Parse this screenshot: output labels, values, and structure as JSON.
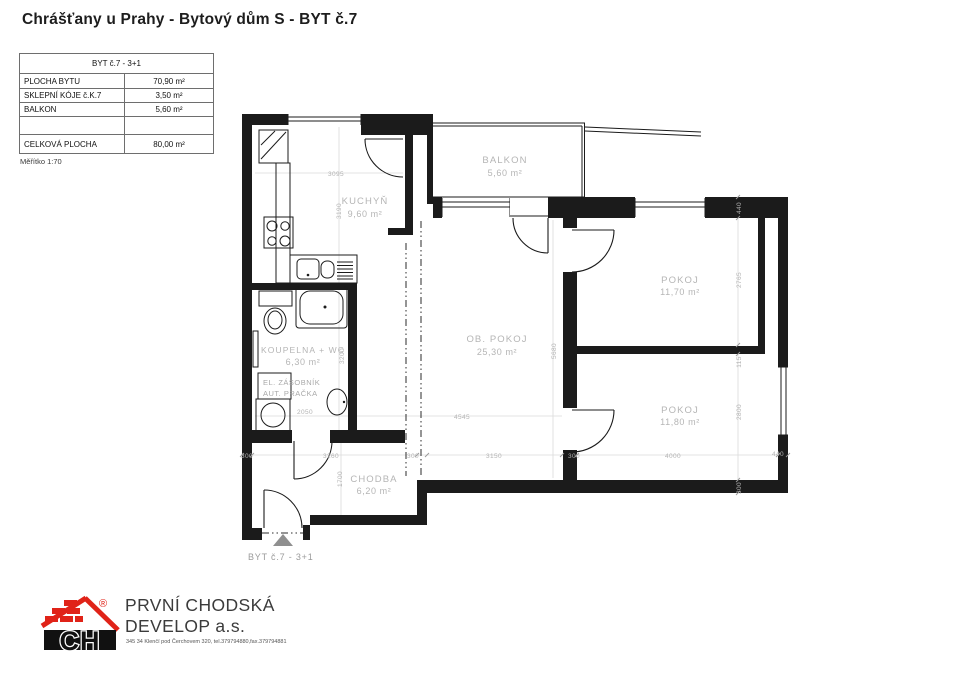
{
  "header": {
    "title": "Chrášťany u Prahy - Bytový dům S - BYT č.7"
  },
  "info_table": {
    "header": "BYT č.7 - 3+1",
    "rows": [
      {
        "label": "PLOCHA BYTU",
        "value": "70,90 m²"
      },
      {
        "label": "SKLEPNÍ KÓJE č.K.7",
        "value": "3,50 m²"
      },
      {
        "label": "BALKON",
        "value": "5,60 m²"
      },
      {
        "label": "",
        "value": ""
      },
      {
        "label": "CELKOVÁ PLOCHA",
        "value": "80,00 m²"
      }
    ],
    "scale_note": "Měřítko 1:70"
  },
  "plan": {
    "rooms": [
      {
        "name": "KUCHYŇ",
        "area": "9,60 m²"
      },
      {
        "name": "BALKON",
        "area": "5,60 m²"
      },
      {
        "name": "OB. POKOJ",
        "area": "25,30 m²"
      },
      {
        "name": "POKOJ",
        "area": "11,70 m²"
      },
      {
        "name": "POKOJ",
        "area": "11,80 m²"
      },
      {
        "name": "KOUPELNA + WC",
        "area": "6,30 m²"
      },
      {
        "name": "CHODBA",
        "area": "6,20 m²"
      }
    ],
    "appliance_labels": [
      "EL. ZÁSOBNÍK",
      "AUT. PRAČKA"
    ],
    "entrance_label": "BYT č.7 - 3+1",
    "dimensions": [
      "3095",
      "3190",
      "5680",
      "4545",
      "3150",
      "2050",
      "3200",
      "300",
      "3260",
      "300",
      "300",
      "4000",
      "440",
      "1700",
      "440",
      "2765",
      "115",
      "2800",
      "300"
    ]
  },
  "footer": {
    "logo_text": "CH",
    "registered_mark": "®",
    "company_line1": "PRVNÍ CHODSKÁ",
    "company_line2": "DEVELOP a.s.",
    "address": "345 34 Klenčí pod Čerchovem 320, tel.379794880,fax.379794881"
  },
  "colors": {
    "wall": "#1b1b1b",
    "label_gray": "#b5b5b5",
    "logo_red": "#e02318"
  }
}
